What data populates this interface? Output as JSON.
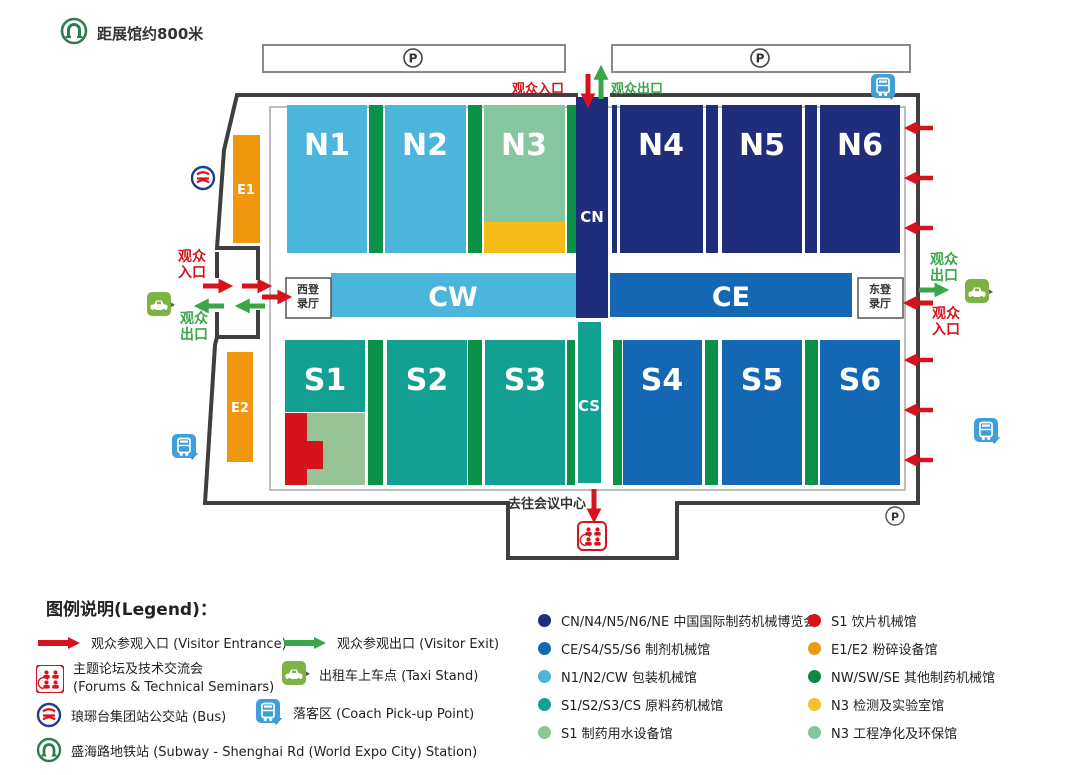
{
  "header": {
    "metro_note": "距展馆约800米"
  },
  "map": {
    "parking": "P",
    "top_entrance": "观众入口",
    "top_exit": "观众出口",
    "west_entrance": "观众入口",
    "west_exit": "观众出口",
    "east_entrance": "观众入口",
    "east_exit": "观众出口",
    "west_reg_hall": "西登录厅",
    "east_reg_hall": "东登录厅",
    "to_conference": "去往会议中心",
    "halls": {
      "n1": "N1",
      "n2": "N2",
      "n3": "N3",
      "n4": "N4",
      "n5": "N5",
      "n6": "N6",
      "s1": "S1",
      "s2": "S2",
      "s3": "S3",
      "s4": "S4",
      "s5": "S5",
      "s6": "S6",
      "cw": "CW",
      "ce": "CE",
      "cn": "CN",
      "cs": "CS",
      "e1": "E1",
      "e2": "E2"
    }
  },
  "legend": {
    "title": "图例说明(Legend)：",
    "entrance": "观众参观入口 (Visitor Entrance)",
    "exit": "观众参观出口 (Visitor Exit)",
    "forums_line1": "主题论坛及技术交流会",
    "forums_line2": "(Forums & Technical Seminars)",
    "taxi": "出租车上车点 (Taxi Stand)",
    "bus_station": "琅琊台集团站公交站 (Bus)",
    "coach": "落客区 (Coach Pick-up Point)",
    "subway": "盛海路地铁站 (Subway - Shenghai Rd (World Expo City) Station)",
    "halls_col1": [
      {
        "color": "#1f2d7b",
        "label": "CN/N4/N5/N6/NE 中国国际制药机械博览会"
      },
      {
        "color": "#1467b3",
        "label": "CE/S4/S5/S6 制剂机械馆"
      },
      {
        "color": "#4cb5dc",
        "label": "N1/N2/CW 包装机械馆"
      },
      {
        "color": "#12a093",
        "label": "S1/S2/S3/CS 原料药机械馆"
      },
      {
        "color": "#8fc493",
        "label": "S1 制药用水设备馆"
      }
    ],
    "halls_col2": [
      {
        "color": "#d6131c",
        "label": "S1 饮片机械馆"
      },
      {
        "color": "#eb9b13",
        "label": "E1/E2 粉碎设备馆"
      },
      {
        "color": "#0c8a43",
        "label": "NW/SW/SE 其他制药机械馆"
      },
      {
        "color": "#f0c32c",
        "label": "N3 检测及实验室馆"
      },
      {
        "color": "#82c7a2",
        "label": "N3 工程净化及环保馆"
      }
    ]
  },
  "colors": {
    "navy": "#1f2d7b",
    "blue": "#1467b3",
    "light_blue": "#4cb5dc",
    "teal": "#12a093",
    "strip_green": "#0a9147",
    "sage": "#98c397",
    "n3_green": "#86c7a2",
    "yellow": "#f5bb17",
    "orange": "#f0960f",
    "red": "#d6131c",
    "arrow_green": "#3aa648",
    "boundary": "#3f3f3f"
  }
}
